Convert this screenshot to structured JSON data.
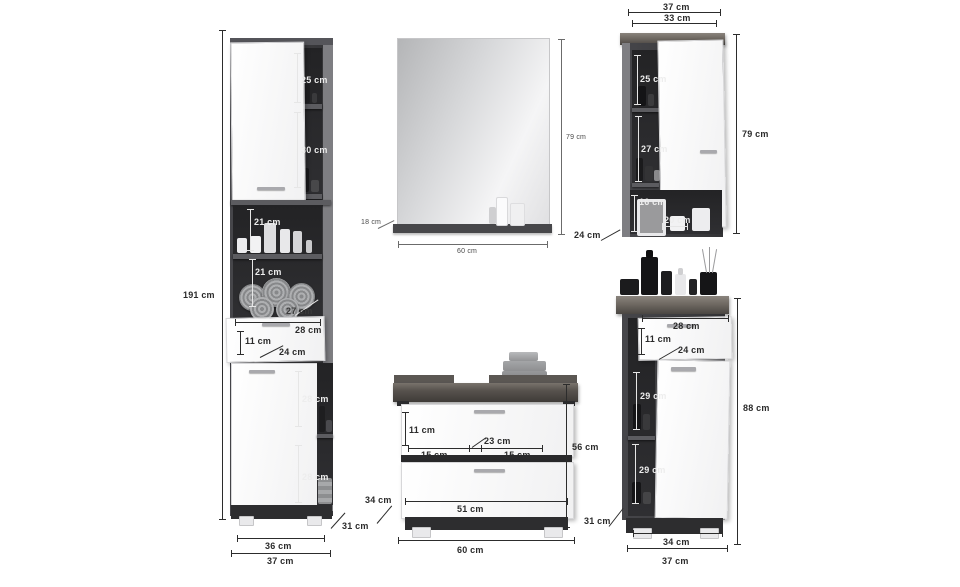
{
  "colors": {
    "background": "#ffffff",
    "carcass_dark": "#3a3a3d",
    "niche_interior": "#2a2a2c",
    "front_white": "#fafafa",
    "wood_top": "#6f6962",
    "dim_line_dark": "#2c2c2c",
    "dim_line_light": "#e6e6e6"
  },
  "pieces": {
    "tall_cabinet": {
      "dims": {
        "height": "191 cm",
        "niche_top": "25 cm",
        "niche_second": "30 cm",
        "niche_third": "21 cm",
        "niche_fourth": "21 cm",
        "niche_depth": "27 cm",
        "drawer_width": "28 cm",
        "drawer_height": "11 cm",
        "drawer_depth": "24 cm",
        "niche_fifth": "28 cm",
        "niche_sixth": "28 cm",
        "depth": "31 cm",
        "inner_width": "36 cm",
        "width": "37 cm"
      }
    },
    "mirror": {
      "dims": {
        "height": "79 cm",
        "shelf_depth": "18 cm",
        "width": "60 cm"
      }
    },
    "wall_cabinet": {
      "dims": {
        "width": "37 cm",
        "inner_width": "33 cm",
        "niche_top": "25 cm",
        "niche_middle": "27 cm",
        "niche_bottom_height": "16 cm",
        "niche_bottom_width": "20 cm",
        "height": "79 cm",
        "depth": "24 cm"
      }
    },
    "washbasin_cabinet": {
      "dims": {
        "drawer_height": "11 cm",
        "cutout_width": "23 cm",
        "left_width": "15 cm",
        "right_width": "15 cm",
        "lower_width": "51 cm",
        "height": "56 cm",
        "depth": "34 cm",
        "width": "60 cm"
      }
    },
    "floor_cabinet": {
      "dims": {
        "drawer_width": "28 cm",
        "drawer_height": "11 cm",
        "drawer_depth": "24 cm",
        "niche_upper": "29 cm",
        "niche_lower": "29 cm",
        "height": "88 cm",
        "depth": "31 cm",
        "inner_width": "34 cm",
        "width": "37 cm"
      }
    }
  }
}
